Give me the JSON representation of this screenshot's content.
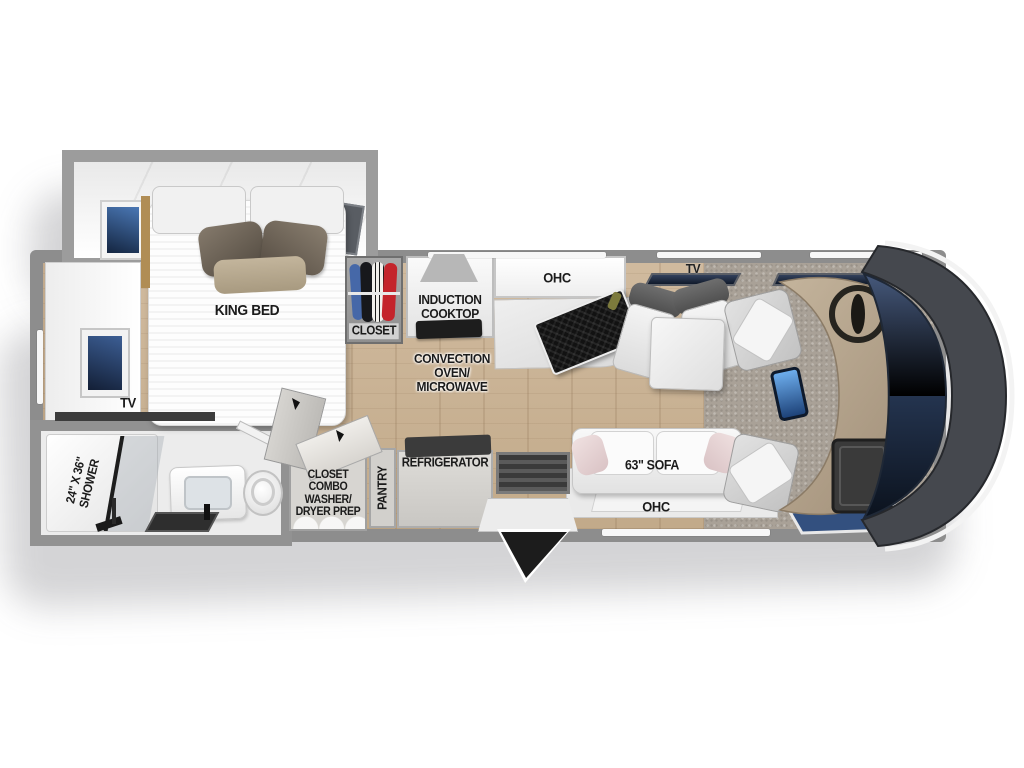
{
  "labels": {
    "king_bed": "KING BED",
    "bedroom_tv": "TV",
    "shower": "24\" X 36\"\nSHOWER",
    "wardrobe_closet": "CLOSET",
    "induction_cooktop": "INDUCTION\nCOOKTOP",
    "kitchen_ohc": "OHC",
    "convection_microwave": "CONVECTION\nOVEN/\nMICROWAVE",
    "living_tv": "TV",
    "sofa": "63\" SOFA",
    "sofa_ohc": "OHC",
    "refrigerator": "REFRIGERATOR",
    "pantry": "PANTRY",
    "washer_dryer_closet": "CLOSET\nCOMBO\nWASHER/\nDRYER PREP"
  },
  "colors": {
    "floor_wood": "#c8b094",
    "wall_gray": "#8d8d8d",
    "carpet_gray": "#a8a098",
    "windshield_navy": "#16202f",
    "dashboard_tan": "#b4a48c",
    "touchscreen_blue": "#3f74b8",
    "label_text": "#1b1b1b",
    "sofa_pillow_pink": "#e9d8d8",
    "sink_black": "#141414",
    "fridge_top_dark": "#3b3b3b"
  },
  "closet_items": {
    "hanging_clothes_colors": [
      "#4668a8",
      "#17181c",
      "#f2f0ec",
      "#c4242b"
    ]
  }
}
